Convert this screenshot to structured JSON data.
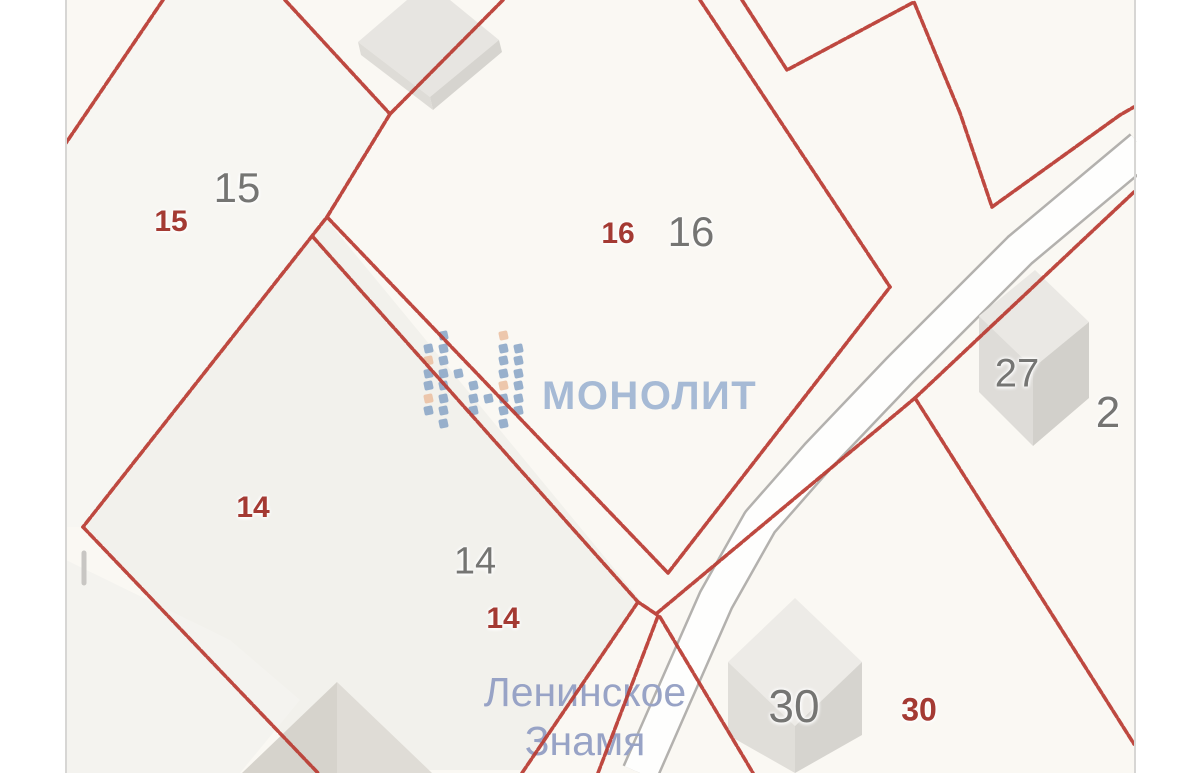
{
  "map": {
    "watermark": {
      "brand_text": "МОНОЛИТ",
      "logo_pattern": [
        ".b...o.",
        "bb...bb",
        "ob...bb",
        "bbb..bb",
        "bb.b.ob",
        "ob.bbbb",
        "bb.b.bb",
        ".b...b."
      ]
    },
    "place_label": {
      "line1": "Ленинское",
      "line2": "Знамя"
    },
    "parcel_labels": [
      {
        "text": "15",
        "type": "gray",
        "x": 237,
        "y": 188,
        "size": 42
      },
      {
        "text": "15",
        "type": "red",
        "x": 171,
        "y": 222,
        "size": 30
      },
      {
        "text": "16",
        "type": "red",
        "x": 618,
        "y": 234,
        "size": 30
      },
      {
        "text": "16",
        "type": "gray",
        "x": 691,
        "y": 232,
        "size": 42
      },
      {
        "text": "14",
        "type": "red",
        "x": 253,
        "y": 508,
        "size": 30
      },
      {
        "text": "14",
        "type": "gray",
        "x": 475,
        "y": 562,
        "size": 38
      },
      {
        "text": "14",
        "type": "red",
        "x": 503,
        "y": 619,
        "size": 30
      },
      {
        "text": "27",
        "type": "gray",
        "x": 1017,
        "y": 374,
        "size": 40
      },
      {
        "text": "2",
        "type": "gray",
        "x": 1108,
        "y": 413,
        "size": 44
      },
      {
        "text": "30",
        "type": "gray",
        "x": 794,
        "y": 706,
        "size": 46
      },
      {
        "text": "30",
        "type": "red",
        "x": 919,
        "y": 710,
        "size": 32
      }
    ],
    "colors": {
      "boundary": "#b93a31",
      "red_label": "#a43a33",
      "gray_label": "#757573",
      "place_color": "#98a3c6",
      "wm_text": "#a6bad5",
      "wm_blue": "#8aa5c6",
      "wm_orange": "#eabfa2",
      "map_bg": "#faf8f3",
      "road_fill": "#fefefd",
      "road_edge": "#b3b1ae"
    }
  }
}
